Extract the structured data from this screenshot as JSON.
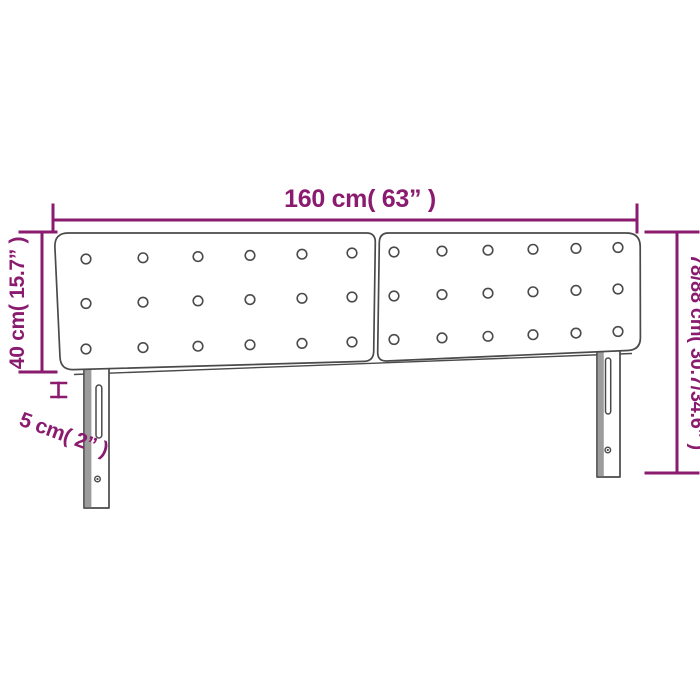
{
  "labels": {
    "width": "160 cm( 63” )",
    "height": "40 cm( 15.7” )",
    "thickness": "5 cm( 2” )",
    "total_height": "78/88 cm( 30.7/34.6” )"
  },
  "colors": {
    "accent": "#8A1B6E",
    "outline": "#4A4A4A",
    "shade": "#9C9C9C",
    "background": "#FFFFFF"
  },
  "buttons_layout": {
    "panels": [
      {
        "cols": [
          86,
          143,
          198,
          250,
          302,
          352
        ],
        "rows": [
          [
            259,
            253
          ],
          [
            303.5,
            297
          ],
          [
            349,
            342
          ]
        ]
      },
      {
        "cols": [
          394,
          442,
          488,
          533,
          576,
          618
        ],
        "rows": [
          [
            252,
            247.5
          ],
          [
            296,
            289
          ],
          [
            339.5,
            331.5
          ]
        ]
      }
    ],
    "radius": 4.8
  }
}
